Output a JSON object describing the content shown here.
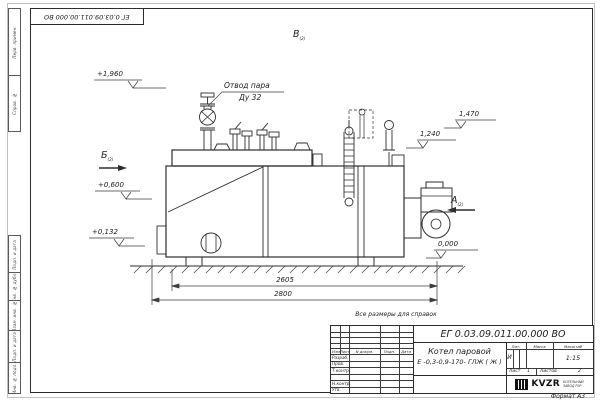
{
  "sheet": {
    "format_note": "Формат А3",
    "reference_note": "Все размеры для справок"
  },
  "corner_stamp": {
    "doc_number": "ЕГ 0.03.09.011.00.000  ВО"
  },
  "margin_strip": {
    "cells": [
      {
        "label": "Перв. примен."
      },
      {
        "label": "Справ. №"
      },
      {
        "label": "Подп. и дата"
      },
      {
        "label": "Инв. № дубл."
      },
      {
        "label": "Взам. инв. №"
      },
      {
        "label": "Подп. и дата"
      },
      {
        "label": "Инв. № подл."
      }
    ]
  },
  "drawing": {
    "callout_steam": {
      "line1": "Отвод пара",
      "line2": "Ду 32"
    },
    "view_labels": {
      "b": "Б",
      "v": "В",
      "a": "А",
      "sheet_ref": "(2)"
    },
    "elevations": {
      "e1960": "+1,960",
      "e0600": "+0,600",
      "e0132": "+0,132",
      "e1470": "1,470",
      "e1240": "1,240",
      "e0000": "0,000"
    },
    "dimensions": {
      "inner": "2605",
      "overall": "2800"
    }
  },
  "title_block": {
    "doc_number": "ЕГ 0.03.09.011.00.000  ВО",
    "product": {
      "line1": "Котел паровой",
      "line2": "Е -0,3-0,9-170- ГЛЖ ( Ж )"
    },
    "sign_header": {
      "izm": "Изм",
      "list": "Лист",
      "doc": "N докум.",
      "podp": "Подп.",
      "data": "Дата"
    },
    "sign_rows": [
      "Разраб.",
      "Пров.",
      "Т.контр.",
      "",
      "Н.контр.",
      "Утв."
    ],
    "props": {
      "lit": "Лит.",
      "mass": "Масса",
      "scale": "Масштаб",
      "lit_value": "И",
      "scale_value": "1:15"
    },
    "sheets": {
      "sheet_label": "Лист",
      "sheet_value": "1",
      "sheets_label": "Листов",
      "sheets_value": "2"
    },
    "company": {
      "logo": "KVZR",
      "tagline1": "КОТЕЛЬНЫЙ",
      "tagline2": "ЗАВОД РЭР"
    }
  }
}
